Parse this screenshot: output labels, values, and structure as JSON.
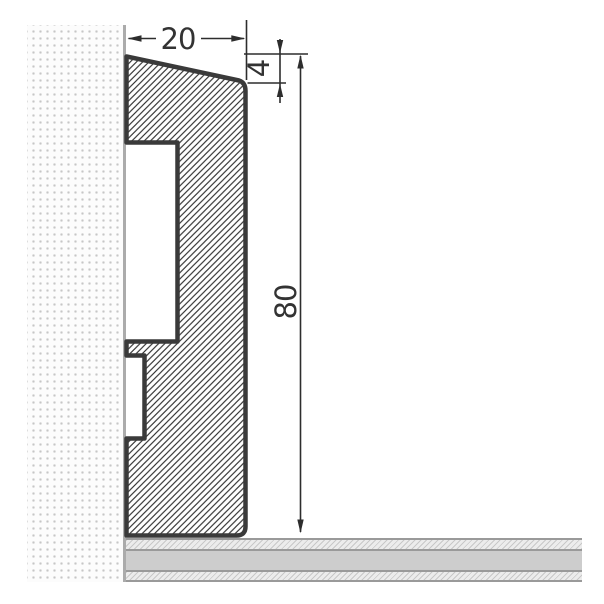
{
  "drawing": {
    "dimensions": {
      "width_label": "20",
      "bevel_label": "4",
      "height_label": "80"
    },
    "colors": {
      "profile_outline": "#3a3a3a",
      "hatch_line": "#2f2f2f",
      "dimension_ink": "#2d2d2d",
      "dimension_text": "#333333",
      "wall_dot": "#c6c6c6",
      "wall_edge": "#ababab",
      "floor_border": "#9a9a9a",
      "floor_screed": "#cdcdcd",
      "floor_hatch_bg": "#ececec"
    }
  }
}
